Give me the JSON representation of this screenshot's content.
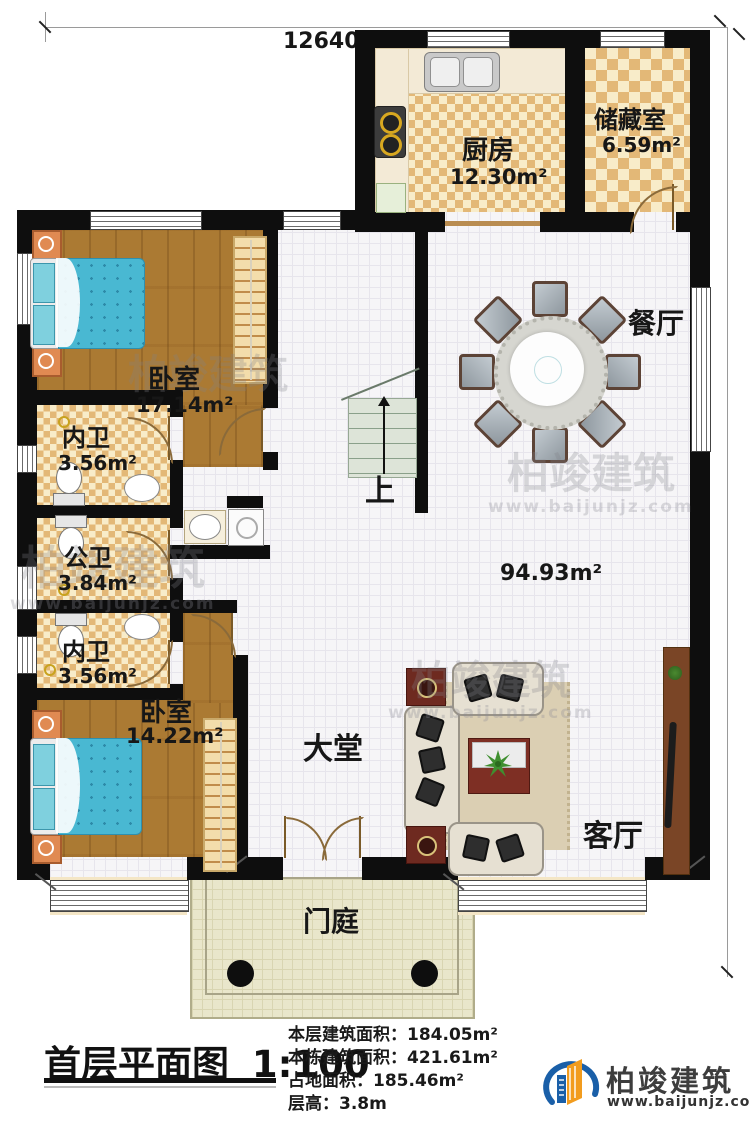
{
  "plan": {
    "dim_top": "12640",
    "dim_right": "17640",
    "rooms": {
      "kitchen": {
        "name": "厨房",
        "area": "12.30m²"
      },
      "storage": {
        "name": "储藏室",
        "area": "6.59m²"
      },
      "dining": {
        "name": "餐厅"
      },
      "bedroom1": {
        "name": "卧室",
        "area": "17.14m²"
      },
      "ensuite1": {
        "name": "内卫",
        "area": "3.56m²"
      },
      "public_bath": {
        "name": "公卫",
        "area": "3.84m²"
      },
      "ensuite2": {
        "name": "内卫",
        "area": "3.56m²"
      },
      "bedroom2": {
        "name": "卧室",
        "area": "14.22m²"
      },
      "hall": {
        "name": "大堂"
      },
      "living": {
        "name": "客厅"
      },
      "porch": {
        "name": "门庭"
      }
    },
    "open_area": "94.93m²",
    "stairs_label": "上"
  },
  "footer": {
    "title": "首层平面图",
    "scale": "1:100",
    "stats": [
      {
        "label": "本层建筑面积：",
        "value": "184.05m²"
      },
      {
        "label": "本栋建筑面积：",
        "value": "421.61m²"
      },
      {
        "label": "占地面积：",
        "value": "185.46m²"
      },
      {
        "label": "层高：",
        "value": "3.8m"
      }
    ]
  },
  "brand": {
    "name": "柏竣建筑",
    "url": "www.baijunjz.com"
  },
  "colors": {
    "wall": "#0e0e0e",
    "wood_floor": "#ab7a33",
    "tile_checker": "#e3b877",
    "bed": "#49b8d2",
    "brand_blue": "#1a5fa8",
    "brand_orange": "#f29c1e"
  }
}
